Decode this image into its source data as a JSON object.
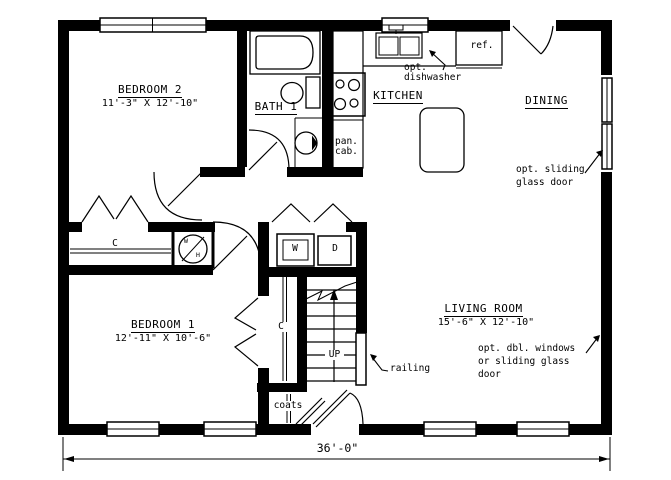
{
  "colors": {
    "ink": "#000000",
    "bg": "#ffffff"
  },
  "rooms": {
    "bedroom2": {
      "name": "BEDROOM 2",
      "dims": "11'-3\" X 12'-10\""
    },
    "bath1": {
      "name": "BATH 1"
    },
    "kitchen": {
      "name": "KITCHEN"
    },
    "dining": {
      "name": "DINING"
    },
    "bedroom1": {
      "name": "BEDROOM 1",
      "dims": "12'-11\" X 10'-6\""
    },
    "living": {
      "name": "LIVING ROOM",
      "dims": "15'-6\" X 12'-10\""
    }
  },
  "fixtures": {
    "washer": "W",
    "dryer": "D",
    "water_heater_top": "W",
    "water_heater_bottom": "H",
    "closet_hall": "C",
    "closet_bedroom1": "C",
    "refrigerator": "ref.",
    "pantry_line1": "pan.",
    "pantry_line2": "cab.",
    "coats": "coats",
    "stairs_up": "UP"
  },
  "annotations": {
    "dishwasher_line1": "opt.",
    "dishwasher_line2": "dishwasher",
    "sliding_line1": "opt. sliding",
    "sliding_line2": "glass door",
    "dblwin_line1": "opt. dbl. windows",
    "dblwin_line2": "or sliding glass",
    "dblwin_line3": "door",
    "railing": "railing"
  },
  "dimensions": {
    "overall_width": "36'-0\""
  }
}
